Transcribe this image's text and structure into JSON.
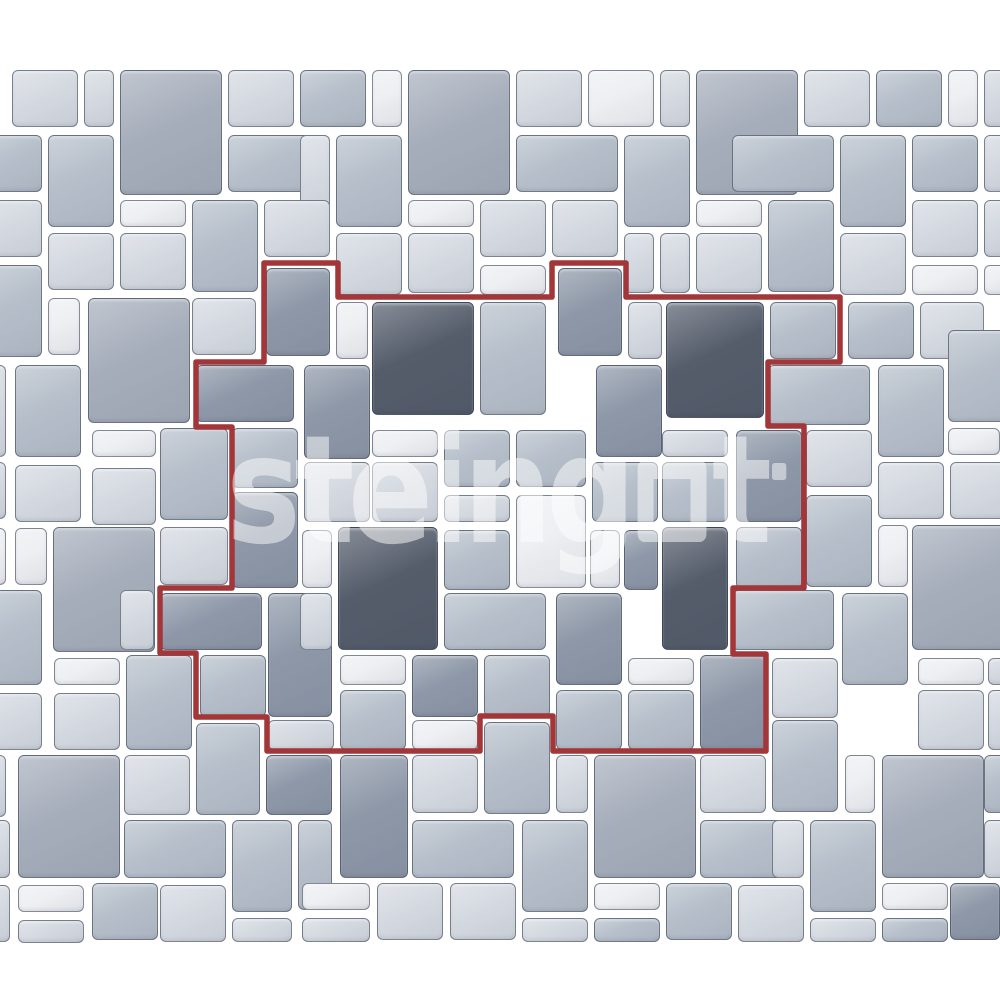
{
  "canvas": {
    "width": 1000,
    "height": 1000,
    "background": "#ffffff"
  },
  "palette": {
    "A": "#edeff2",
    "B": "#d5dae1",
    "C": "#b6bfca",
    "D": "#8e98a8",
    "M": "#a6aebb",
    "E": "#555d6b",
    "tile_border": "#2b364a",
    "grout_background": "#ffffff",
    "outline_red": "#a23639"
  },
  "watermark": {
    "text": "steingot",
    "part1": "steing",
    "part2": "t",
    "color": "#ffffff",
    "opacity": 0.5
  },
  "red_region": {
    "stroke_width": 5.5,
    "points": "264,263 338,263 338,297 552,297 552,263 626,263 626,297 840,297 840,362 768,362 768,426 804,426 804,588 733,588 733,654 766,654 766,751 553,751 553,716 480,716 480,751 267,751 267,717 196,717 196,653 160,653 160,588 232,588 232,427 196,427 196,362 264,362"
  },
  "tiles": [
    [
      12,
      70,
      66,
      57,
      "B"
    ],
    [
      84,
      70,
      30,
      57,
      "B"
    ],
    [
      120,
      70,
      102,
      125,
      "M"
    ],
    [
      228,
      70,
      66,
      57,
      "B"
    ],
    [
      300,
      70,
      66,
      57,
      "C"
    ],
    [
      372,
      70,
      30,
      57,
      "A"
    ],
    [
      408,
      70,
      102,
      125,
      "M"
    ],
    [
      516,
      70,
      66,
      57,
      "B"
    ],
    [
      588,
      70,
      66,
      57,
      "A"
    ],
    [
      660,
      70,
      30,
      57,
      "B"
    ],
    [
      696,
      70,
      102,
      125,
      "M"
    ],
    [
      804,
      70,
      66,
      57,
      "B"
    ],
    [
      876,
      70,
      66,
      57,
      "C"
    ],
    [
      948,
      70,
      30,
      57,
      "A"
    ],
    [
      984,
      70,
      30,
      57,
      "B"
    ],
    [
      -24,
      135,
      66,
      57,
      "C"
    ],
    [
      48,
      135,
      66,
      92,
      "C"
    ],
    [
      228,
      135,
      102,
      57,
      "C"
    ],
    [
      300,
      135,
      30,
      92,
      "B"
    ],
    [
      336,
      135,
      66,
      92,
      "C"
    ],
    [
      516,
      135,
      102,
      57,
      "C"
    ],
    [
      624,
      135,
      66,
      92,
      "C"
    ],
    [
      732,
      135,
      102,
      57,
      "C"
    ],
    [
      840,
      135,
      66,
      92,
      "C"
    ],
    [
      912,
      135,
      66,
      57,
      "C"
    ],
    [
      984,
      135,
      30,
      57,
      "B"
    ],
    [
      -24,
      200,
      66,
      57,
      "B"
    ],
    [
      120,
      200,
      66,
      27,
      "A"
    ],
    [
      192,
      200,
      66,
      92,
      "C"
    ],
    [
      264,
      200,
      66,
      57,
      "B"
    ],
    [
      408,
      200,
      66,
      27,
      "A"
    ],
    [
      480,
      200,
      66,
      57,
      "B"
    ],
    [
      552,
      200,
      66,
      57,
      "B"
    ],
    [
      696,
      200,
      66,
      27,
      "A"
    ],
    [
      768,
      200,
      66,
      92,
      "C"
    ],
    [
      912,
      200,
      66,
      57,
      "B"
    ],
    [
      984,
      200,
      30,
      57,
      "B"
    ],
    [
      48,
      233,
      66,
      57,
      "B"
    ],
    [
      120,
      233,
      66,
      57,
      "B"
    ],
    [
      336,
      233,
      66,
      62,
      "B"
    ],
    [
      408,
      233,
      66,
      60,
      "B"
    ],
    [
      624,
      233,
      30,
      60,
      "B"
    ],
    [
      660,
      233,
      30,
      60,
      "B"
    ],
    [
      696,
      233,
      66,
      60,
      "B"
    ],
    [
      840,
      233,
      66,
      62,
      "B"
    ],
    [
      -24,
      265,
      66,
      92,
      "C"
    ],
    [
      48,
      298,
      32,
      57,
      "A"
    ],
    [
      88,
      298,
      102,
      125,
      "M"
    ],
    [
      192,
      298,
      64,
      57,
      "B"
    ],
    [
      480,
      265,
      66,
      30,
      "A"
    ],
    [
      912,
      265,
      66,
      30,
      "A"
    ],
    [
      984,
      265,
      30,
      30,
      "A"
    ],
    [
      266,
      268,
      64,
      88,
      "D"
    ],
    [
      558,
      268,
      64,
      88,
      "D"
    ],
    [
      336,
      302,
      32,
      57,
      "A"
    ],
    [
      372,
      302,
      102,
      113,
      "E"
    ],
    [
      480,
      302,
      66,
      113,
      "C"
    ],
    [
      628,
      302,
      34,
      57,
      "B"
    ],
    [
      666,
      302,
      98,
      116,
      "E"
    ],
    [
      770,
      302,
      66,
      57,
      "C"
    ],
    [
      848,
      302,
      66,
      57,
      "C"
    ],
    [
      920,
      302,
      64,
      57,
      "B"
    ],
    [
      -24,
      365,
      30,
      92,
      "B"
    ],
    [
      15,
      365,
      66,
      92,
      "C"
    ],
    [
      196,
      365,
      98,
      57,
      "D"
    ],
    [
      304,
      365,
      66,
      94,
      "D"
    ],
    [
      596,
      365,
      66,
      92,
      "D"
    ],
    [
      768,
      365,
      102,
      60,
      "C"
    ],
    [
      878,
      365,
      66,
      92,
      "C"
    ],
    [
      948,
      330,
      66,
      92,
      "C"
    ],
    [
      92,
      430,
      64,
      27,
      "A"
    ],
    [
      160,
      428,
      68,
      92,
      "C"
    ],
    [
      232,
      428,
      66,
      60,
      "C"
    ],
    [
      372,
      430,
      66,
      27,
      "A"
    ],
    [
      444,
      430,
      66,
      57,
      "C"
    ],
    [
      516,
      430,
      70,
      57,
      "C"
    ],
    [
      662,
      430,
      66,
      27,
      "B"
    ],
    [
      736,
      430,
      66,
      92,
      "D"
    ],
    [
      806,
      430,
      66,
      57,
      "B"
    ],
    [
      948,
      428,
      52,
      27,
      "A"
    ],
    [
      -24,
      462,
      30,
      57,
      "B"
    ],
    [
      15,
      465,
      66,
      57,
      "B"
    ],
    [
      92,
      468,
      64,
      57,
      "B"
    ],
    [
      304,
      462,
      66,
      60,
      "B"
    ],
    [
      372,
      462,
      66,
      60,
      "B"
    ],
    [
      592,
      462,
      66,
      60,
      "C"
    ],
    [
      662,
      462,
      66,
      60,
      "C"
    ],
    [
      878,
      462,
      66,
      57,
      "B"
    ],
    [
      950,
      462,
      66,
      57,
      "B"
    ],
    [
      232,
      492,
      66,
      96,
      "D"
    ],
    [
      444,
      495,
      66,
      27,
      "B"
    ],
    [
      516,
      495,
      70,
      93,
      "A"
    ],
    [
      806,
      495,
      66,
      92,
      "C"
    ],
    [
      -24,
      528,
      30,
      57,
      "A"
    ],
    [
      15,
      528,
      32,
      57,
      "A"
    ],
    [
      53,
      527,
      102,
      125,
      "M"
    ],
    [
      160,
      527,
      68,
      58,
      "B"
    ],
    [
      302,
      530,
      30,
      58,
      "A"
    ],
    [
      338,
      527,
      100,
      123,
      "E"
    ],
    [
      444,
      530,
      66,
      60,
      "C"
    ],
    [
      590,
      530,
      30,
      58,
      "A"
    ],
    [
      624,
      530,
      34,
      60,
      "D"
    ],
    [
      662,
      527,
      66,
      123,
      "E"
    ],
    [
      736,
      527,
      66,
      62,
      "C"
    ],
    [
      878,
      525,
      30,
      62,
      "A"
    ],
    [
      912,
      525,
      100,
      125,
      "M"
    ],
    [
      -24,
      590,
      66,
      95,
      "C"
    ],
    [
      120,
      590,
      34,
      60,
      "B"
    ],
    [
      160,
      593,
      102,
      57,
      "D"
    ],
    [
      268,
      593,
      64,
      124,
      "D"
    ],
    [
      300,
      593,
      32,
      57,
      "B"
    ],
    [
      444,
      593,
      102,
      57,
      "C"
    ],
    [
      556,
      593,
      66,
      92,
      "D"
    ],
    [
      732,
      590,
      102,
      60,
      "C"
    ],
    [
      842,
      593,
      66,
      92,
      "C"
    ],
    [
      54,
      658,
      66,
      27,
      "A"
    ],
    [
      -24,
      693,
      66,
      57,
      "B"
    ],
    [
      54,
      693,
      66,
      57,
      "B"
    ],
    [
      126,
      655,
      66,
      95,
      "C"
    ],
    [
      200,
      655,
      66,
      62,
      "C"
    ],
    [
      268,
      720,
      66,
      30,
      "B"
    ],
    [
      196,
      723,
      64,
      92,
      "C"
    ],
    [
      340,
      655,
      66,
      30,
      "A"
    ],
    [
      340,
      690,
      66,
      60,
      "C"
    ],
    [
      412,
      655,
      66,
      62,
      "D"
    ],
    [
      412,
      720,
      66,
      30,
      "A"
    ],
    [
      484,
      655,
      66,
      62,
      "C"
    ],
    [
      484,
      722,
      66,
      92,
      "C"
    ],
    [
      556,
      690,
      66,
      60,
      "C"
    ],
    [
      628,
      658,
      66,
      27,
      "A"
    ],
    [
      628,
      690,
      66,
      60,
      "C"
    ],
    [
      700,
      655,
      66,
      95,
      "D"
    ],
    [
      772,
      658,
      66,
      60,
      "B"
    ],
    [
      772,
      720,
      66,
      92,
      "C"
    ],
    [
      918,
      658,
      66,
      27,
      "A"
    ],
    [
      918,
      690,
      66,
      60,
      "B"
    ],
    [
      988,
      658,
      28,
      27,
      "B"
    ],
    [
      988,
      690,
      28,
      60,
      "B"
    ],
    [
      -24,
      755,
      30,
      62,
      "B"
    ],
    [
      18,
      755,
      102,
      123,
      "M"
    ],
    [
      124,
      755,
      66,
      60,
      "B"
    ],
    [
      266,
      755,
      66,
      60,
      "D"
    ],
    [
      340,
      755,
      68,
      123,
      "D"
    ],
    [
      412,
      755,
      66,
      58,
      "B"
    ],
    [
      556,
      755,
      32,
      58,
      "B"
    ],
    [
      594,
      755,
      102,
      123,
      "M"
    ],
    [
      700,
      755,
      66,
      58,
      "B"
    ],
    [
      845,
      755,
      30,
      58,
      "A"
    ],
    [
      882,
      755,
      102,
      123,
      "M"
    ],
    [
      984,
      755,
      30,
      58,
      "C"
    ],
    [
      -20,
      820,
      30,
      58,
      "B"
    ],
    [
      124,
      820,
      102,
      58,
      "C"
    ],
    [
      232,
      820,
      60,
      92,
      "C"
    ],
    [
      298,
      820,
      34,
      90,
      "C"
    ],
    [
      412,
      820,
      102,
      58,
      "C"
    ],
    [
      522,
      820,
      66,
      92,
      "C"
    ],
    [
      700,
      820,
      102,
      58,
      "C"
    ],
    [
      772,
      820,
      32,
      58,
      "B"
    ],
    [
      810,
      820,
      66,
      92,
      "C"
    ],
    [
      984,
      820,
      30,
      58,
      "B"
    ],
    [
      -20,
      885,
      30,
      57,
      "B"
    ],
    [
      18,
      885,
      66,
      27,
      "A"
    ],
    [
      18,
      920,
      66,
      23,
      "B"
    ],
    [
      92,
      883,
      66,
      57,
      "C"
    ],
    [
      160,
      885,
      66,
      57,
      "B"
    ],
    [
      232,
      918,
      60,
      24,
      "B"
    ],
    [
      302,
      883,
      68,
      27,
      "A"
    ],
    [
      302,
      918,
      68,
      24,
      "B"
    ],
    [
      377,
      883,
      66,
      57,
      "B"
    ],
    [
      450,
      883,
      66,
      57,
      "B"
    ],
    [
      522,
      918,
      66,
      24,
      "B"
    ],
    [
      594,
      883,
      66,
      27,
      "A"
    ],
    [
      594,
      918,
      66,
      24,
      "C"
    ],
    [
      666,
      883,
      66,
      57,
      "C"
    ],
    [
      738,
      885,
      66,
      57,
      "B"
    ],
    [
      810,
      918,
      66,
      24,
      "B"
    ],
    [
      882,
      883,
      66,
      27,
      "A"
    ],
    [
      882,
      918,
      66,
      24,
      "C"
    ],
    [
      950,
      883,
      50,
      57,
      "D"
    ]
  ]
}
